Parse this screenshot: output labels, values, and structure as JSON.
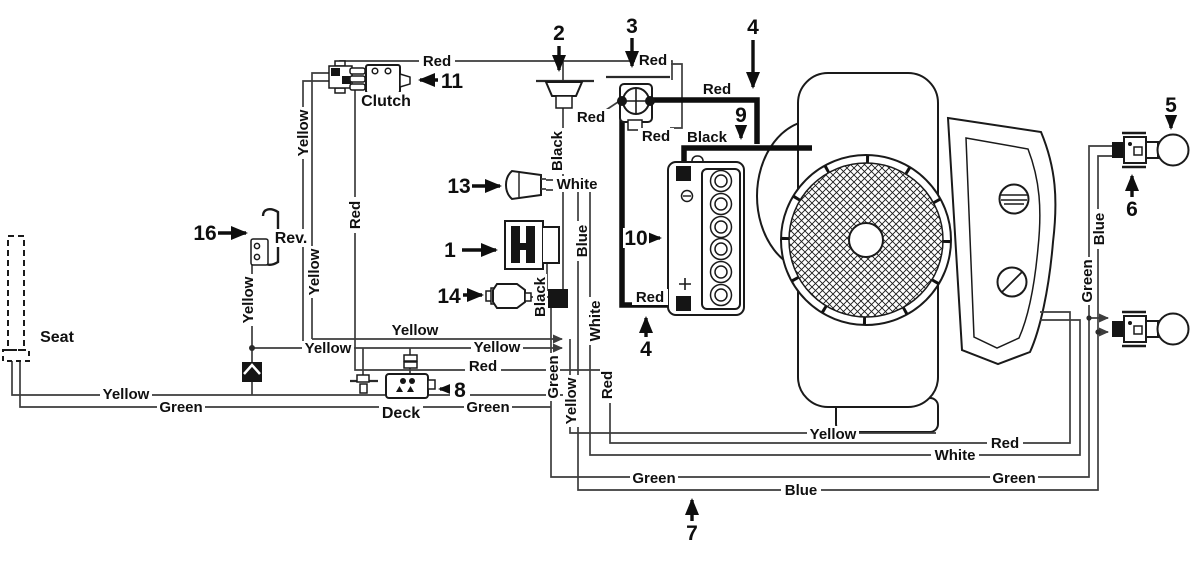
{
  "diagram": {
    "title": "Tractor wiring diagram",
    "components": {
      "seat": "Seat",
      "clutch": "Clutch",
      "rev_switch": "Rev.",
      "deck": "Deck"
    },
    "callouts": {
      "n1": "1",
      "n2": "2",
      "n3": "3",
      "n4_top": "4",
      "n4_bottom": "4",
      "n5": "5",
      "n6": "6",
      "n7": "7",
      "n8": "8",
      "n9": "9",
      "n10": "10",
      "n11": "11",
      "n13": "13",
      "n14": "14",
      "n16": "16"
    },
    "wire_labels": {
      "red_clutch_top": "Red",
      "red_sol_top": "Red",
      "red_sol_out": "Red",
      "red_sol_left": "Red",
      "red_sol_bottom": "Red",
      "red_battery": "Red",
      "red_clutch_vert": "Red",
      "red_deck": "Red",
      "red_vert": "Red",
      "red_bottom": "Red",
      "black_fuse": "Black",
      "black_battery": "Black",
      "black_key": "Black",
      "yellow_left_upper": "Yellow",
      "yellow_left_lower": "Yellow",
      "yellow_rev": "Yellow",
      "yellow_mid_upper": "Yellow",
      "yellow_mid_left": "Yellow",
      "yellow_mid_right": "Yellow",
      "yellow_seat": "Yellow",
      "yellow_vert": "Yellow",
      "yellow_bottom": "Yellow",
      "white_switch": "White",
      "white_vert": "White",
      "white_bottom": "White",
      "blue_vert": "Blue",
      "blue_bottom": "Blue",
      "blue_right": "Blue",
      "green_vert": "Green",
      "green_seat": "Green",
      "green_deck": "Green",
      "green_bottom": "Green",
      "green_right_bottom": "Green",
      "green_right": "Green"
    }
  }
}
